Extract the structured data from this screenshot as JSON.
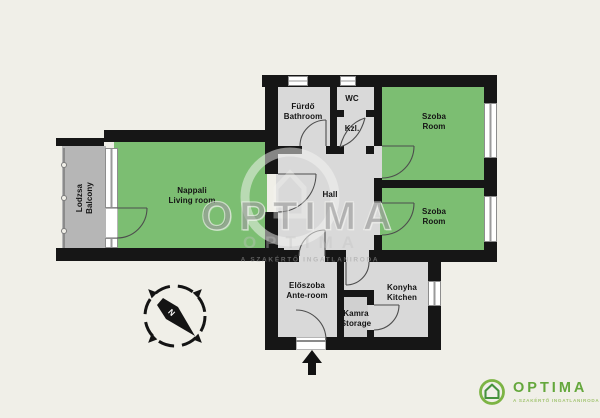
{
  "rooms": {
    "balcony": {
      "hu": "Lodzsa",
      "en": "Balcony"
    },
    "living": {
      "hu": "Nappali",
      "en": "Living room"
    },
    "bathroom": {
      "hu": "Fürdő",
      "en": "Bathroom"
    },
    "wc": {
      "hu": "WC"
    },
    "kzl": {
      "hu": "Kzl."
    },
    "room1": {
      "hu": "Szoba",
      "en": "Room"
    },
    "hall": {
      "hu": "Hall"
    },
    "room2": {
      "hu": "Szoba",
      "en": "Room"
    },
    "anteroom": {
      "hu": "Előszoba",
      "en": "Ante-room"
    },
    "storage": {
      "hu": "Kamra",
      "en": "Storage"
    },
    "kitchen": {
      "hu": "Konyha",
      "en": "Kitchen"
    }
  },
  "compass": {
    "north_label": "N"
  },
  "watermark": {
    "text": "OPTIMA",
    "tagline": "A SZAKÉRTŐ INGATLANIRODA"
  },
  "logo": {
    "name": "OPTIMA",
    "tagline": "A SZAKÉRTŐ INGATLANIRODA"
  },
  "colors": {
    "background": "#f0efe8",
    "wall": "#161616",
    "room_green": "#7cbe72",
    "room_gray": "#d9d9d9",
    "storage_gray": "#d0d0d0",
    "balcony_gray": "#b6b6b6",
    "logo_green": "#64a73c",
    "logo_light_green": "#a3c573"
  }
}
